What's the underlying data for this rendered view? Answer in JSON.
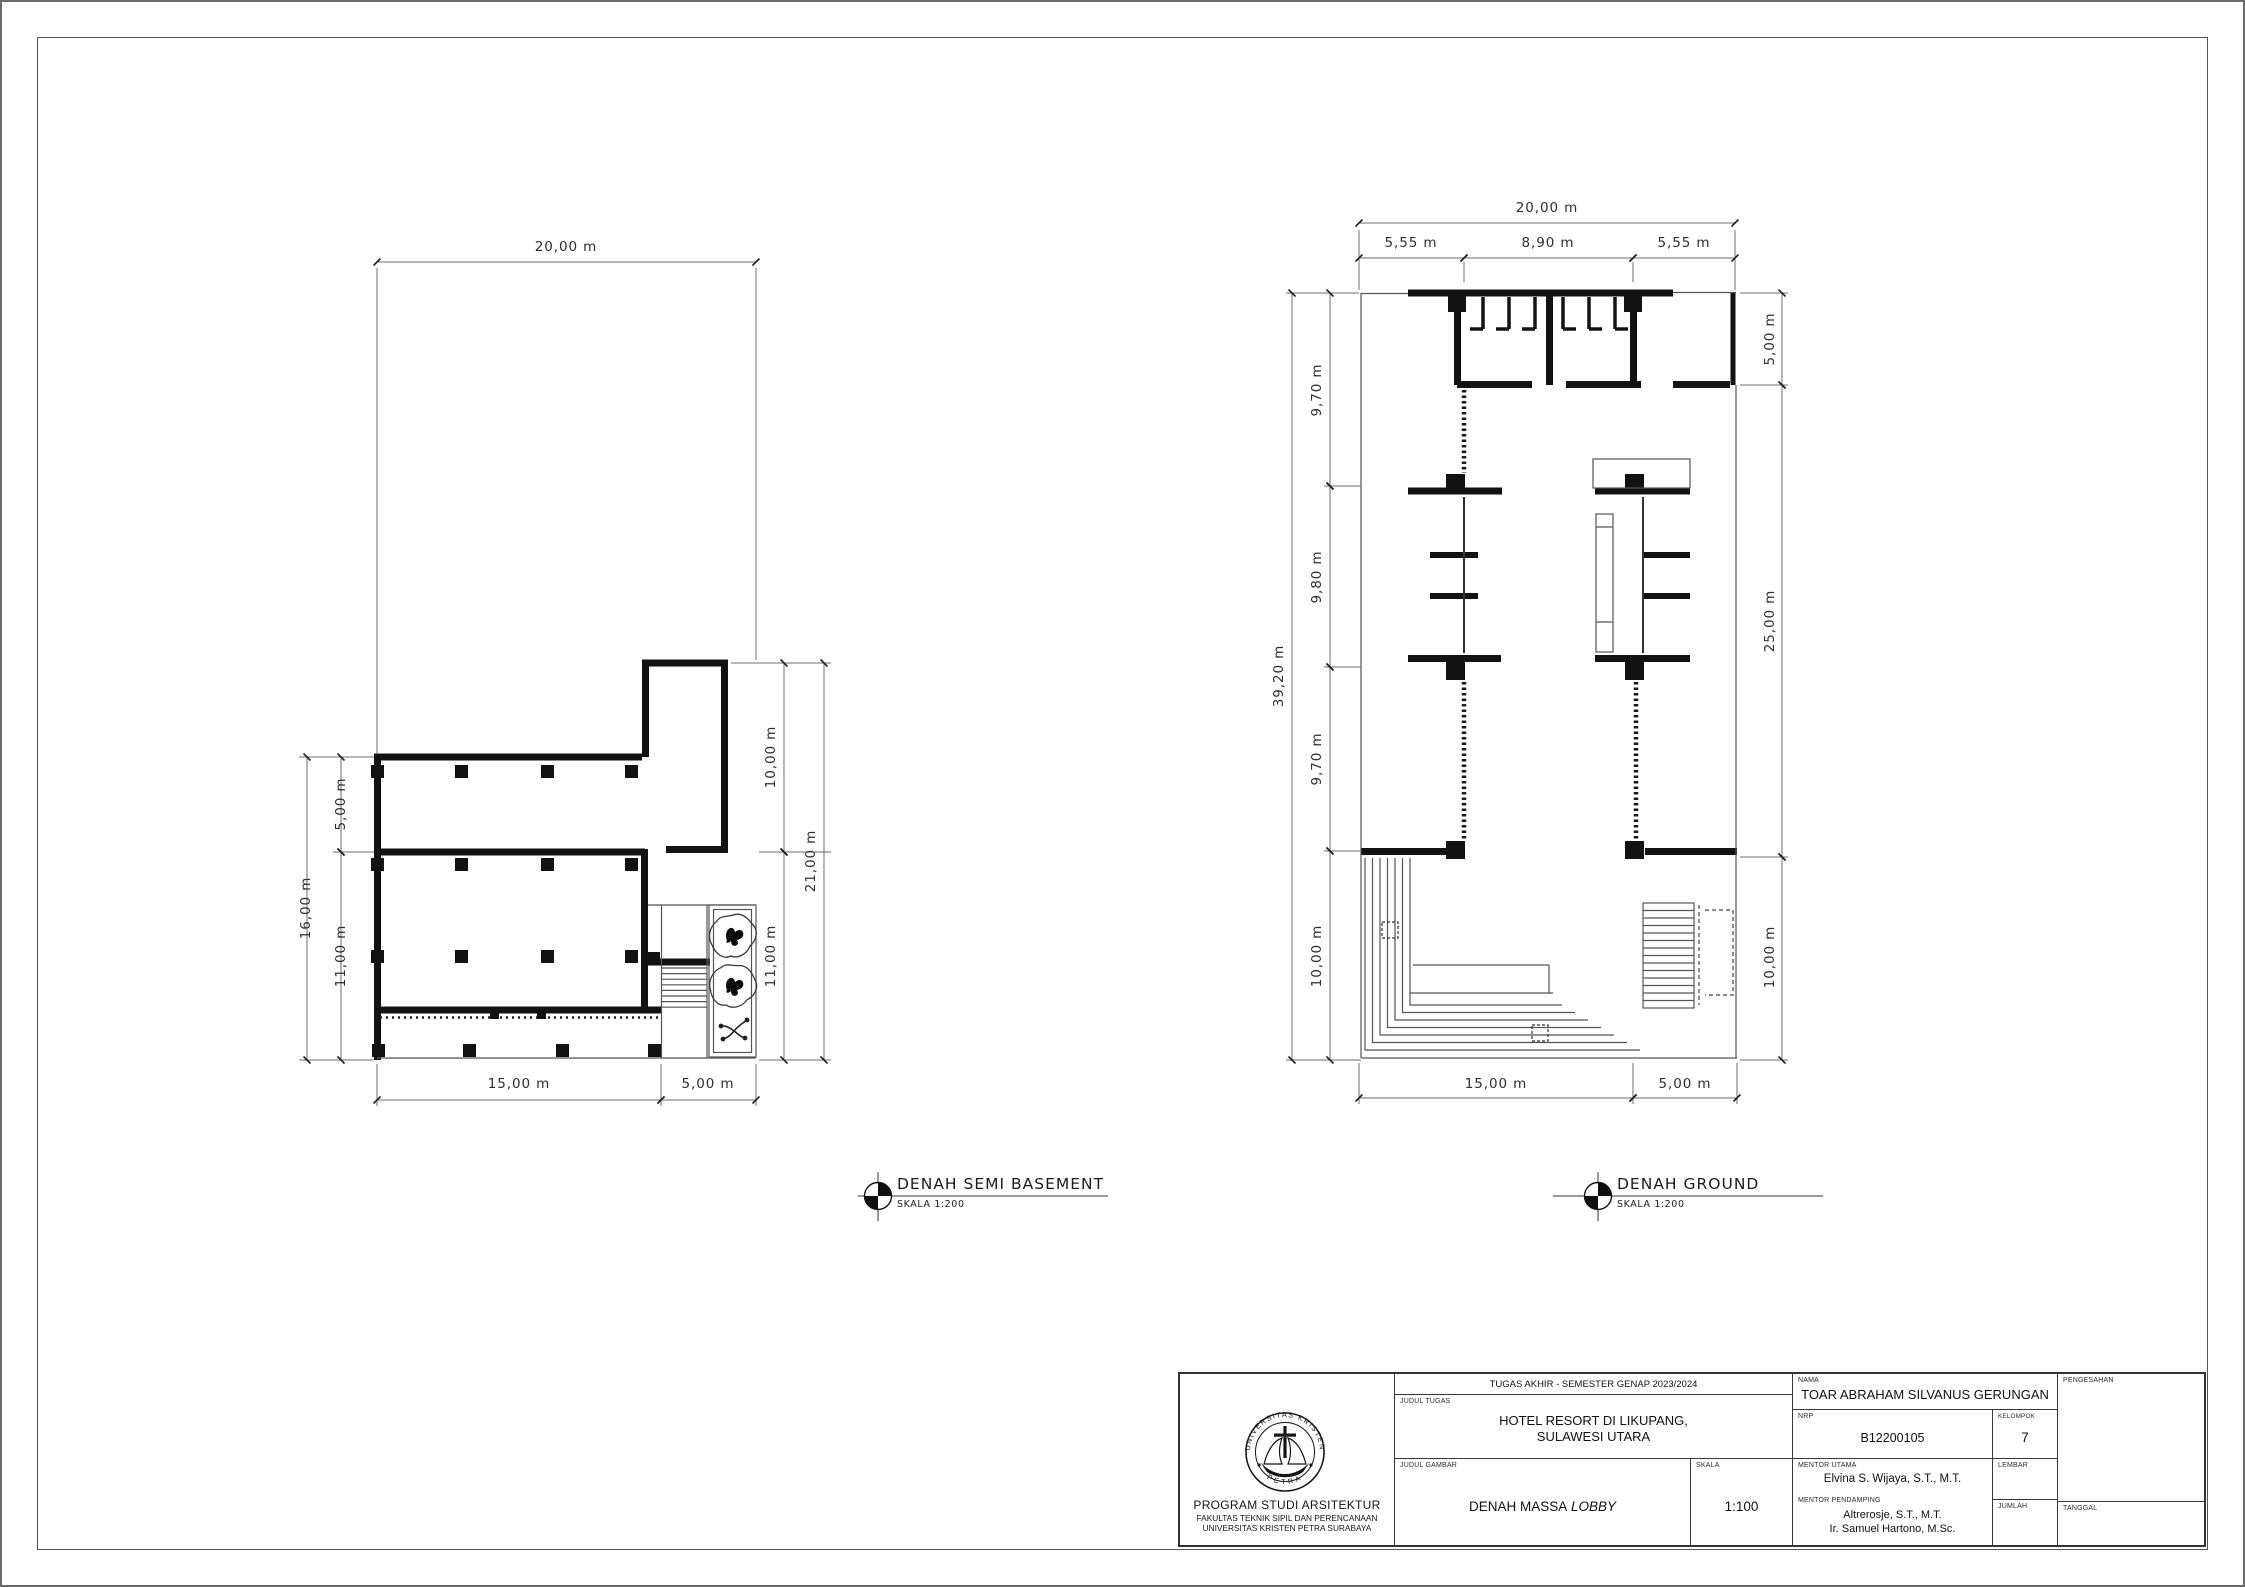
{
  "plans": {
    "semi_basement": {
      "title": "DENAH SEMI BASEMENT",
      "scale_label": "SKALA 1:200",
      "marker_icon": "north-quadrant-marker",
      "dims": {
        "top": "20,00 m",
        "left_total": "16,00 m",
        "left_seg1": "5,00 m",
        "left_seg2": "11,00 m",
        "right_seg1": "10,00 m",
        "right_seg2": "11,00 m",
        "right_total": "21,00 m",
        "bottom_seg1": "15,00 m",
        "bottom_seg2": "5,00 m"
      }
    },
    "ground": {
      "title": "DENAH GROUND",
      "scale_label": "SKALA 1:200",
      "marker_icon": "north-quadrant-marker",
      "dims": {
        "top_total": "20,00 m",
        "top_seg1": "5,55 m",
        "top_seg2": "8,90 m",
        "top_seg3": "5,55 m",
        "left_total": "39,20 m",
        "left_seg1": "9,70 m",
        "left_seg2": "9,80 m",
        "left_seg3": "9,70 m",
        "left_seg4": "10,00 m",
        "right_seg1": "5,00 m",
        "right_seg2": "25,00 m",
        "right_seg3": "10,00 m",
        "bottom_seg1": "15,00 m",
        "bottom_seg2": "5,00 m"
      }
    }
  },
  "title_block": {
    "header": "TUGAS AKHIR - SEMESTER GENAP 2023/2024",
    "labels": {
      "judul_tugas": "JUDUL TUGAS",
      "judul_gambar": "JUDUL GAMBAR",
      "skala": "SKALA",
      "nama": "NAMA",
      "nrp": "NRP",
      "kelompok": "KELOMPOK",
      "mentor_utama": "MENTOR UTAMA",
      "mentor_pendamping": "MENTOR PENDAMPING",
      "lembar": "LEMBAR",
      "jumlah": "JUMLAH",
      "pengesahan": "PENGESAHAN",
      "tanggal": "TANGGAL"
    },
    "judul_tugas_line1": "HOTEL RESORT DI LIKUPANG,",
    "judul_tugas_line2": "SULAWESI UTARA",
    "judul_gambar_main": "DENAH MASSA",
    "judul_gambar_italic": "LOBBY",
    "skala_value": "1:100",
    "nama_value": "TOAR ABRAHAM SILVANUS GERUNGAN",
    "nrp_value": "B12200105",
    "kelompok_value": "7",
    "mentor_utama_value": "Elvina S. Wijaya, S.T., M.T.",
    "mentor_pendamping_value1": "Altrerosje, S.T., M.T.",
    "mentor_pendamping_value2": "Ir. Samuel Hartono, M.Sc.",
    "institution": {
      "line1": "PROGRAM STUDI ARSITEKTUR",
      "line2": "FAKULTAS TEKNIK SIPIL DAN PERENCANAAN",
      "line3": "UNIVERSITAS KRISTEN PETRA SURABAYA"
    },
    "logo": {
      "icon": "universitas-kristen-petra-seal-icon",
      "top_text": "UNIVERSITAS KRISTEN",
      "bottom_text": "PETRA"
    }
  }
}
